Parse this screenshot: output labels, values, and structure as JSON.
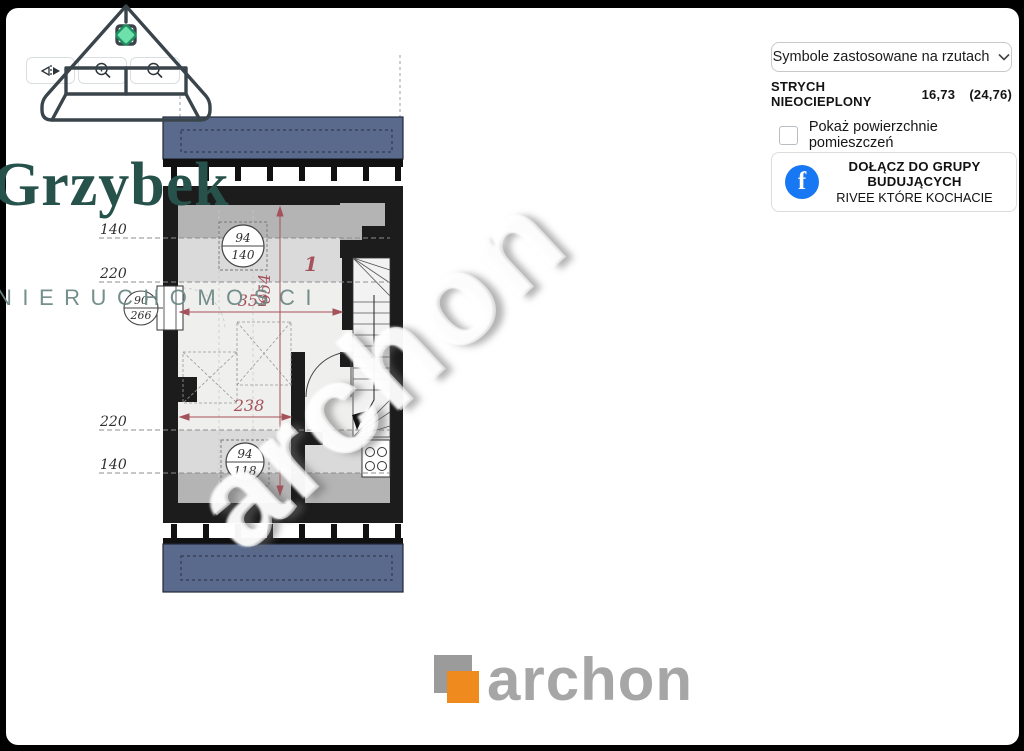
{
  "window": {
    "bg": "#000000",
    "card_bg": "#ffffff"
  },
  "toolbar": {
    "flip_button": "flip-horizontal",
    "zoom_in_button": "zoom-in",
    "zoom_out_button": "zoom-out"
  },
  "brand": {
    "name": "Grzybek",
    "tagline": "NIERUCHOMOŚCI"
  },
  "sidebar": {
    "symbols_button_label": "Symbole zastosowane na rzutach",
    "area_label": "STRYCH NIEOCIEPLONY",
    "area_value": "16,73",
    "area_value_secondary": "(24,76)",
    "checkbox_label": "Pokaż powierzchnie pomieszczeń",
    "facebook": {
      "line1": "DOŁĄCZ DO GRUPY",
      "line2": "BUDUJĄCYCH",
      "line3": "RIVEE KTÓRE KOCHACIE"
    }
  },
  "plan": {
    "room_number": "1",
    "dim_width_top": "352",
    "dim_height": "654",
    "dim_width_bottom": "238",
    "height_line_top_1": "140",
    "height_line_top_2": "220",
    "height_line_bottom_1": "220",
    "height_line_bottom_2": "140",
    "window_symbols": {
      "skylight_top": {
        "top": "94",
        "bottom": "140"
      },
      "wall_window": {
        "top": "90",
        "bottom": "266"
      },
      "skylight_bottom": {
        "top": "94",
        "bottom": "118"
      }
    },
    "watermark": "archon"
  },
  "footer": {
    "logo_text": "archon"
  },
  "colors": {
    "roof_blue": "#5a6a8c",
    "wall_black": "#1c1c1c",
    "dimension_red": "#a4525c",
    "facebook_blue": "#1877f2",
    "archon_orange": "#ef8a1f",
    "brand_teal": "#26524b",
    "diamond_mint": "#6ee0ab"
  }
}
